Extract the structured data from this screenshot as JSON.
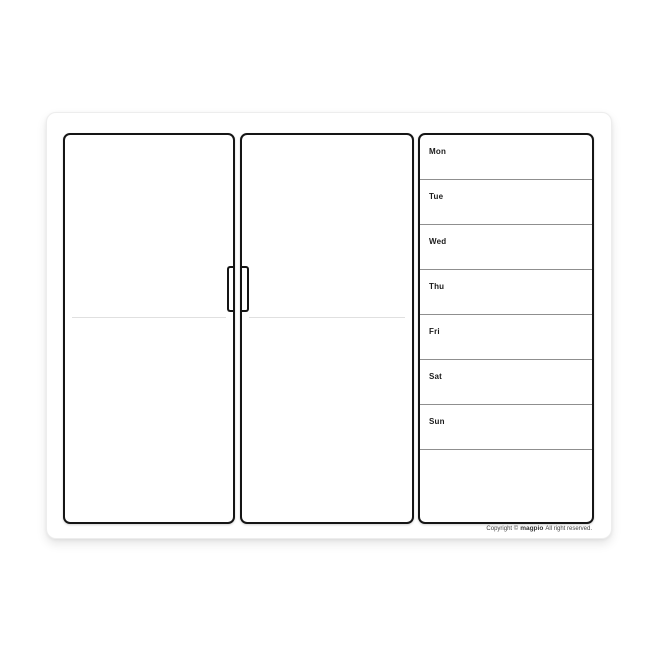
{
  "sheet": {
    "description": "weekly-planner-whiteboard-sheet",
    "background": "#ffffff"
  },
  "week": {
    "days": [
      "Mon",
      "Tue",
      "Wed",
      "Thu",
      "Fri",
      "Sat",
      "Sun"
    ]
  },
  "footer": {
    "prefix": "Copyright ©",
    "brand": "magpio",
    "suffix": "All right reserved."
  },
  "colors": {
    "panel_border": "#151515",
    "row_line": "#8f8f8f",
    "door_crease": "#e0e0e0",
    "day_label": "#1a1a1a",
    "footer_text": "#444444",
    "sheet_background": "#ffffff",
    "page_background": "#ffffff"
  }
}
